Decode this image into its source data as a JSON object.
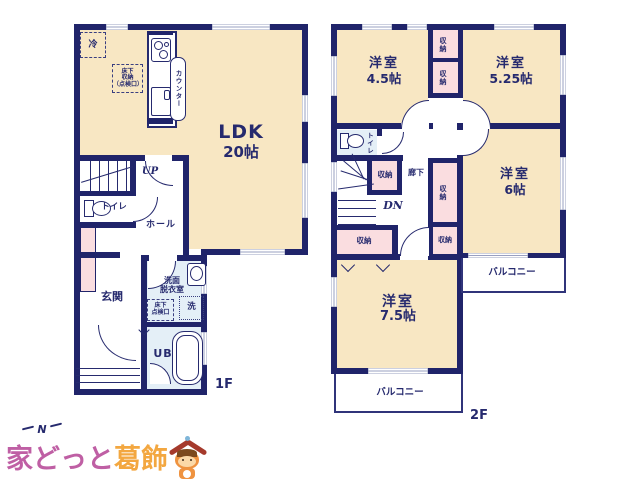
{
  "colors": {
    "wall": "#20246a",
    "room_cream": "#f8e7c3",
    "storage_pink": "#fadde0",
    "bath_blue": "#e4eff7",
    "logo_pink": "#bf5fa4",
    "logo_orange": "#f3a740",
    "mascot_roof": "#a53a2c",
    "mascot_body": "#ef9340"
  },
  "compass": {
    "north": "N"
  },
  "logo": {
    "text_primary": "家どっと",
    "text_secondary": "葛飾"
  },
  "floor1": {
    "label": "1F",
    "ldk": {
      "name": "LDK",
      "size": "20帖"
    },
    "kitchen": {
      "counter": "カウンター",
      "fridge": "冷",
      "underfloor_storage": "床下\n収納\n（点検口）"
    },
    "stairs_up": "UP",
    "toilet": "トイレ",
    "hall": "ホール",
    "entrance": "玄関",
    "washroom": "洗面\n脱衣室",
    "inspection": "床下\n点検口",
    "washer": "洗",
    "bath": "UB"
  },
  "floor2": {
    "label": "2F",
    "rooms": {
      "r45": {
        "name": "洋室",
        "size": "4.5帖"
      },
      "r525": {
        "name": "洋室",
        "size": "5.25帖"
      },
      "r6": {
        "name": "洋室",
        "size": "6帖"
      },
      "r75": {
        "name": "洋室",
        "size": "7.5帖"
      }
    },
    "toilet": "トイレ",
    "hallway": "廊下",
    "stairs_down": "DN",
    "storage": "収納",
    "balcony": "バルコニー"
  }
}
